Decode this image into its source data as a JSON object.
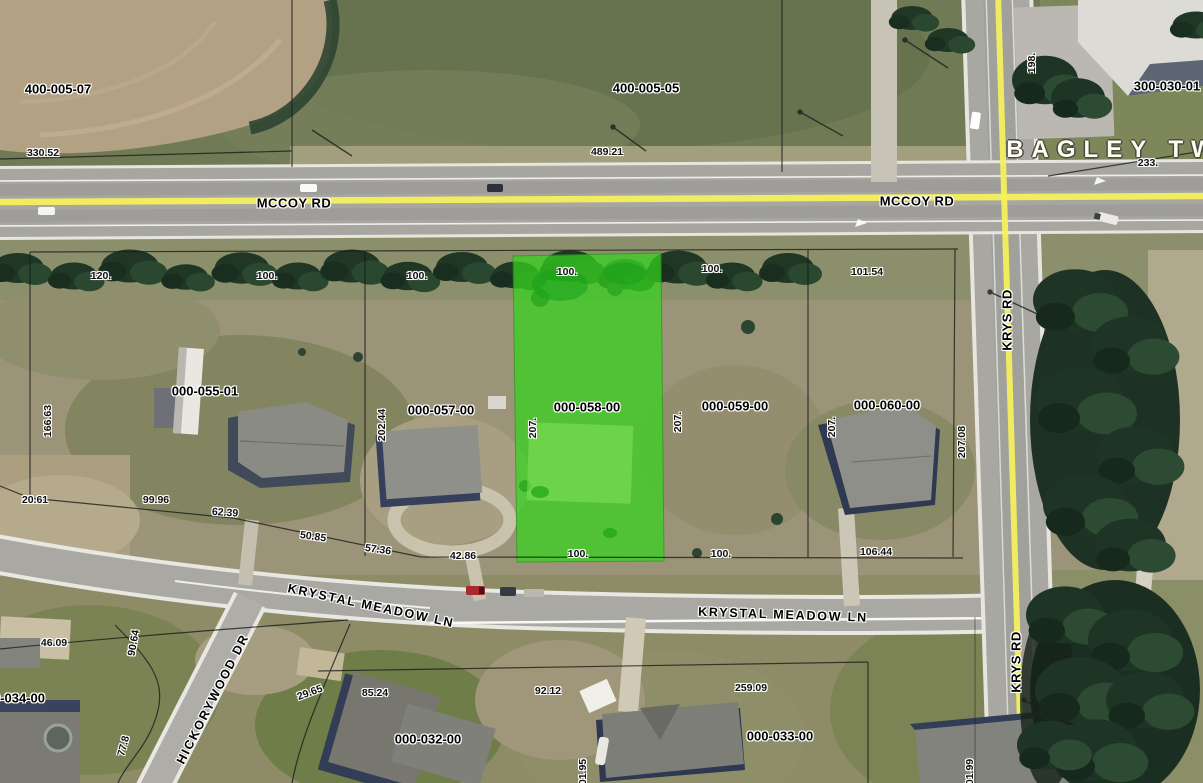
{
  "map": {
    "township_name": "BAGLEY TWP",
    "highlighted_parcel_id": "000-058-00",
    "colors": {
      "parcel_highlight": "#35d51e",
      "road_centerline": "#f6ef5d",
      "boundary_line": "#1a1a1a",
      "township_label": "#fdfdf0"
    },
    "roads": [
      "MCCOY RD",
      "KRYS RD",
      "KRYSTAL MEADOW LN",
      "HICKORYWOOD DR"
    ],
    "labels": [
      {
        "name": "parcel-label-400-005-07",
        "text": "400-005-07",
        "x": 58,
        "y": 89,
        "cls": "pid"
      },
      {
        "name": "parcel-label-400-005-05",
        "text": "400-005-05",
        "x": 646,
        "y": 88,
        "cls": "pid"
      },
      {
        "name": "parcel-label-300-030-01",
        "text": "300-030-01",
        "x": 1167,
        "y": 86,
        "cls": "pid"
      },
      {
        "name": "parcel-label-000-055-01",
        "text": "000-055-01",
        "x": 205,
        "y": 391,
        "cls": "pid"
      },
      {
        "name": "parcel-label-000-057-00",
        "text": "000-057-00",
        "x": 441,
        "y": 410,
        "cls": "pid"
      },
      {
        "name": "parcel-label-000-058-00",
        "text": "000-058-00",
        "x": 587,
        "y": 407,
        "cls": "pid"
      },
      {
        "name": "parcel-label-000-059-00",
        "text": "000-059-00",
        "x": 735,
        "y": 406,
        "cls": "pid"
      },
      {
        "name": "parcel-label-000-060-00",
        "text": "000-060-00",
        "x": 887,
        "y": 405,
        "cls": "pid"
      },
      {
        "name": "parcel-label-000-032-00",
        "text": "000-032-00",
        "x": 428,
        "y": 739,
        "cls": "pid"
      },
      {
        "name": "parcel-label-000-033-00",
        "text": "000-033-00",
        "x": 780,
        "y": 736,
        "cls": "pid"
      },
      {
        "name": "parcel-label-000-034-00-partial",
        "text": "0-034-00",
        "x": 19,
        "y": 698,
        "cls": "pid"
      },
      {
        "name": "dimension-330-52",
        "text": "330.52",
        "x": 43,
        "y": 153,
        "cls": "dim"
      },
      {
        "name": "dimension-489-21",
        "text": "489.21",
        "x": 607,
        "y": 152,
        "cls": "dim"
      },
      {
        "name": "dimension-198",
        "text": "198.",
        "x": 1032,
        "y": 63,
        "rot": -90,
        "cls": "dim"
      },
      {
        "name": "dimension-233",
        "text": "233.",
        "x": 1148,
        "y": 163,
        "cls": "dim"
      },
      {
        "name": "dimension-120",
        "text": "120.",
        "x": 101,
        "y": 276,
        "cls": "dim"
      },
      {
        "name": "dimension-100-a",
        "text": "100.",
        "x": 267,
        "y": 276,
        "cls": "dim"
      },
      {
        "name": "dimension-100-b",
        "text": "100.",
        "x": 417,
        "y": 276,
        "cls": "dim"
      },
      {
        "name": "dimension-100-c",
        "text": "100.",
        "x": 567,
        "y": 272,
        "cls": "dim"
      },
      {
        "name": "dimension-100-d",
        "text": "100.",
        "x": 712,
        "y": 269,
        "cls": "dim"
      },
      {
        "name": "dimension-101-54",
        "text": "101.54",
        "x": 867,
        "y": 272,
        "cls": "dim"
      },
      {
        "name": "dimension-166-63",
        "text": "166.63",
        "x": 48,
        "y": 421,
        "rot": -90,
        "cls": "dim"
      },
      {
        "name": "dimension-202-44",
        "text": "202.44",
        "x": 382,
        "y": 425,
        "rot": -90,
        "cls": "dim"
      },
      {
        "name": "dimension-207-a",
        "text": "207.",
        "x": 533,
        "y": 428,
        "rot": -90,
        "cls": "dim"
      },
      {
        "name": "dimension-207-b",
        "text": "207.",
        "x": 678,
        "y": 422,
        "rot": -90,
        "cls": "dim"
      },
      {
        "name": "dimension-207-c",
        "text": "207.",
        "x": 832,
        "y": 427,
        "rot": -90,
        "cls": "dim"
      },
      {
        "name": "dimension-207-08",
        "text": "207.08",
        "x": 962,
        "y": 442,
        "rot": -90,
        "cls": "dim"
      },
      {
        "name": "dimension-20-61",
        "text": "20.61",
        "x": 35,
        "y": 500,
        "cls": "dim"
      },
      {
        "name": "dimension-99-96",
        "text": "99.96",
        "x": 156,
        "y": 500,
        "cls": "dim"
      },
      {
        "name": "dimension-62-39",
        "text": "62.39",
        "x": 225,
        "y": 513,
        "rot": 4,
        "cls": "dim"
      },
      {
        "name": "dimension-50-85",
        "text": "50.85",
        "x": 313,
        "y": 537,
        "rot": 8,
        "cls": "dim"
      },
      {
        "name": "dimension-57-36",
        "text": "57.36",
        "x": 378,
        "y": 550,
        "rot": 8,
        "cls": "dim"
      },
      {
        "name": "dimension-42-86",
        "text": "42.86",
        "x": 463,
        "y": 556,
        "cls": "dim"
      },
      {
        "name": "dimension-100-e",
        "text": "100.",
        "x": 578,
        "y": 554,
        "cls": "dim"
      },
      {
        "name": "dimension-100-f",
        "text": "100.",
        "x": 721,
        "y": 554,
        "cls": "dim"
      },
      {
        "name": "dimension-106-44",
        "text": "106.44",
        "x": 876,
        "y": 552,
        "cls": "dim"
      },
      {
        "name": "dimension-46-09",
        "text": "46.09",
        "x": 54,
        "y": 643,
        "cls": "dim"
      },
      {
        "name": "dimension-90-64",
        "text": "90.64",
        "x": 134,
        "y": 643,
        "rot": -80,
        "cls": "dim"
      },
      {
        "name": "dimension-77-8",
        "text": "77.8",
        "x": 124,
        "y": 746,
        "rot": -75,
        "cls": "dim"
      },
      {
        "name": "dimension-29-65",
        "text": "29.65",
        "x": 310,
        "y": 693,
        "rot": -20,
        "cls": "dim"
      },
      {
        "name": "dimension-85-24",
        "text": "85.24",
        "x": 375,
        "y": 693,
        "cls": "dim"
      },
      {
        "name": "dimension-92-12",
        "text": "92.12",
        "x": 548,
        "y": 691,
        "cls": "dim"
      },
      {
        "name": "dimension-01-95",
        "text": "01.95",
        "x": 583,
        "y": 772,
        "rot": -90,
        "cls": "dim"
      },
      {
        "name": "dimension-259-09",
        "text": "259.09",
        "x": 751,
        "y": 688,
        "cls": "dim"
      },
      {
        "name": "dimension-01-99",
        "text": "01.99",
        "x": 970,
        "y": 772,
        "rot": -90,
        "cls": "dim"
      },
      {
        "name": "road-label-mccoy-rd-west",
        "text": "MCCOY RD",
        "x": 294,
        "y": 203,
        "cls": "road"
      },
      {
        "name": "road-label-mccoy-rd-east",
        "text": "MCCOY RD",
        "x": 917,
        "y": 201,
        "cls": "road"
      },
      {
        "name": "road-label-krys-rd-north",
        "text": "KRYS RD",
        "x": 1007,
        "y": 320,
        "rot": -90,
        "cls": "road"
      },
      {
        "name": "road-label-krys-rd-south",
        "text": "KRYS RD",
        "x": 1016,
        "y": 662,
        "rot": -90,
        "cls": "road"
      },
      {
        "name": "road-label-krystal-meadow-ln-west",
        "text": "KRYSTAL MEADOW LN",
        "x": 371,
        "y": 606,
        "rot": 12,
        "cls": "krystal"
      },
      {
        "name": "road-label-krystal-meadow-ln-east",
        "text": "KRYSTAL MEADOW LN",
        "x": 783,
        "y": 615,
        "rot": 2,
        "cls": "krystal"
      },
      {
        "name": "road-label-hickorywood-dr",
        "text": "HICKORYWOOD DR",
        "x": 213,
        "y": 699,
        "rot": -63,
        "cls": "krystal"
      },
      {
        "name": "township-label",
        "text": "BAGLEY TWP",
        "x": 1126,
        "y": 150,
        "cls": "twp"
      }
    ]
  }
}
